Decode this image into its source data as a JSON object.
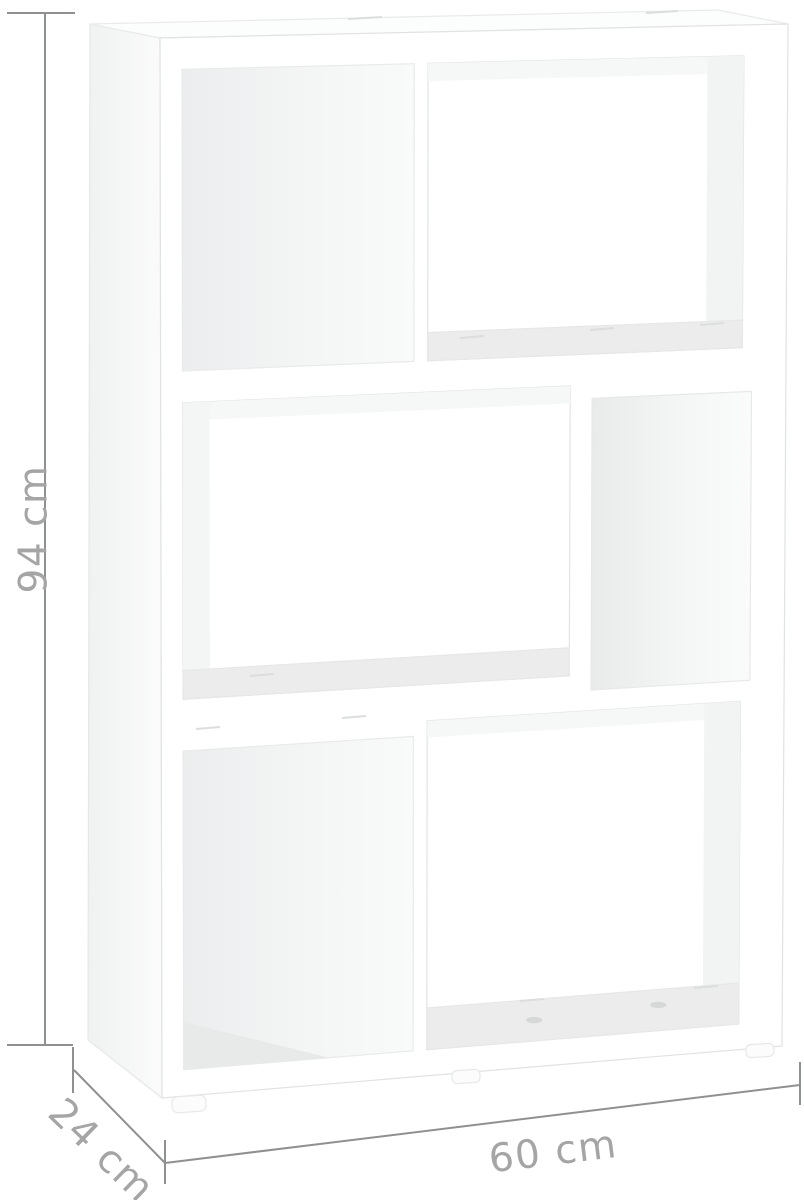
{
  "diagram": {
    "kind": "product-dimension-diagram",
    "product": "white staggered 3-tier cube bookshelf / room divider",
    "dimensions": {
      "height_label": "94 cm",
      "depth_label": "24 cm",
      "width_label": "60 cm"
    },
    "colors": {
      "background": "#ffffff",
      "furniture_fill": "#ffffff",
      "furniture_edge": "#e2e3e3",
      "cavity_shade": "#eef0f0",
      "shelf_shade": "#ececec",
      "dimension_line": "#8f9090",
      "dimension_text": "#a5a5a5"
    }
  }
}
